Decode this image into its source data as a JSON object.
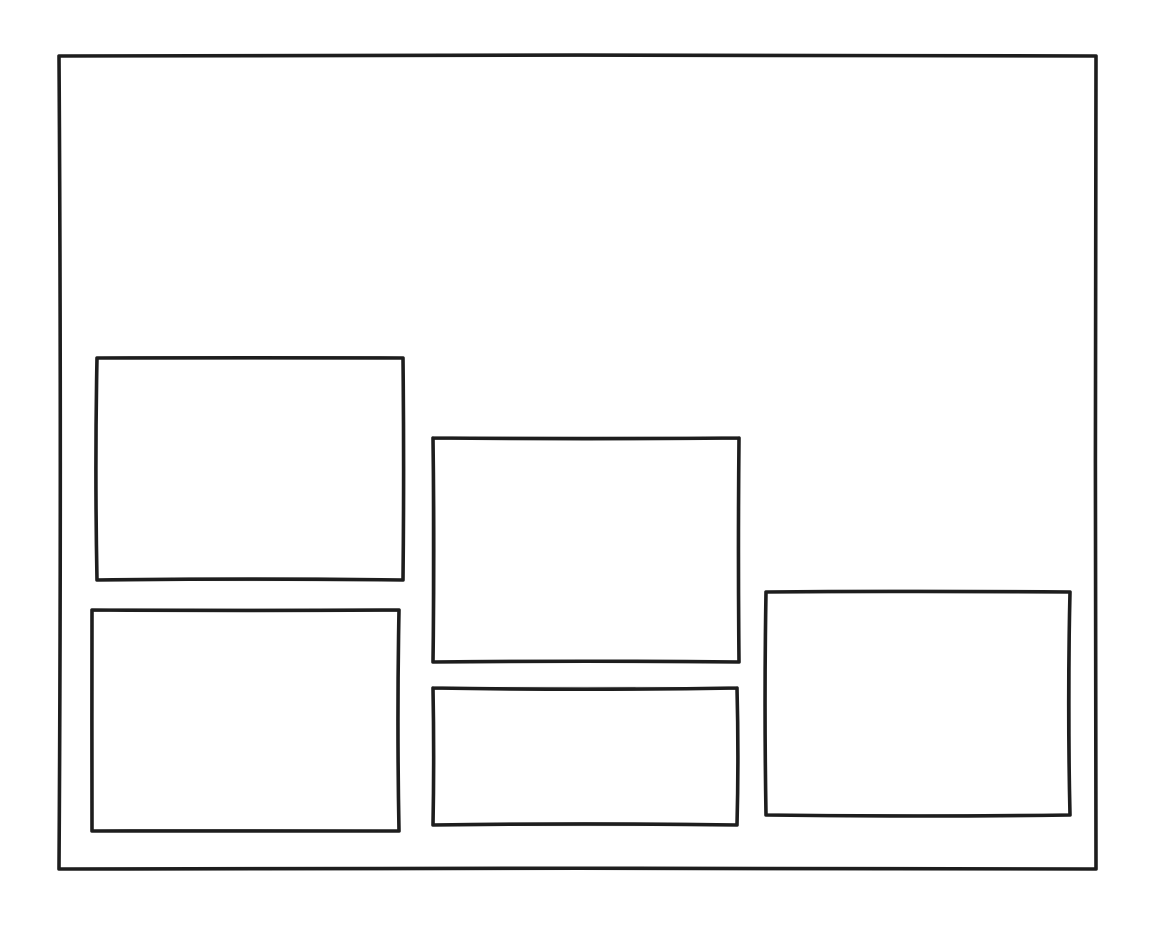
{
  "canvas": {
    "width": 1150,
    "height": 942,
    "background_color": "#ffffff",
    "stroke_color": "#1e1e1e",
    "stroke_width": 3.6,
    "style": "hand-drawn-sketch"
  },
  "diagram": {
    "description": "hand-drawn wireframe: outer frame containing five empty placeholder boxes, no text",
    "frame": {
      "id": "outer-frame",
      "x": 59,
      "y": 56,
      "w": 1037,
      "h": 813
    },
    "boxes": [
      {
        "id": "box-top-left",
        "x": 97,
        "y": 358,
        "w": 306,
        "h": 222
      },
      {
        "id": "box-bottom-left",
        "x": 92,
        "y": 610,
        "w": 307,
        "h": 221
      },
      {
        "id": "box-middle-top",
        "x": 433,
        "y": 438,
        "w": 306,
        "h": 224
      },
      {
        "id": "box-middle-bottom",
        "x": 433,
        "y": 688,
        "w": 304,
        "h": 137
      },
      {
        "id": "box-right",
        "x": 766,
        "y": 592,
        "w": 304,
        "h": 223
      }
    ]
  }
}
